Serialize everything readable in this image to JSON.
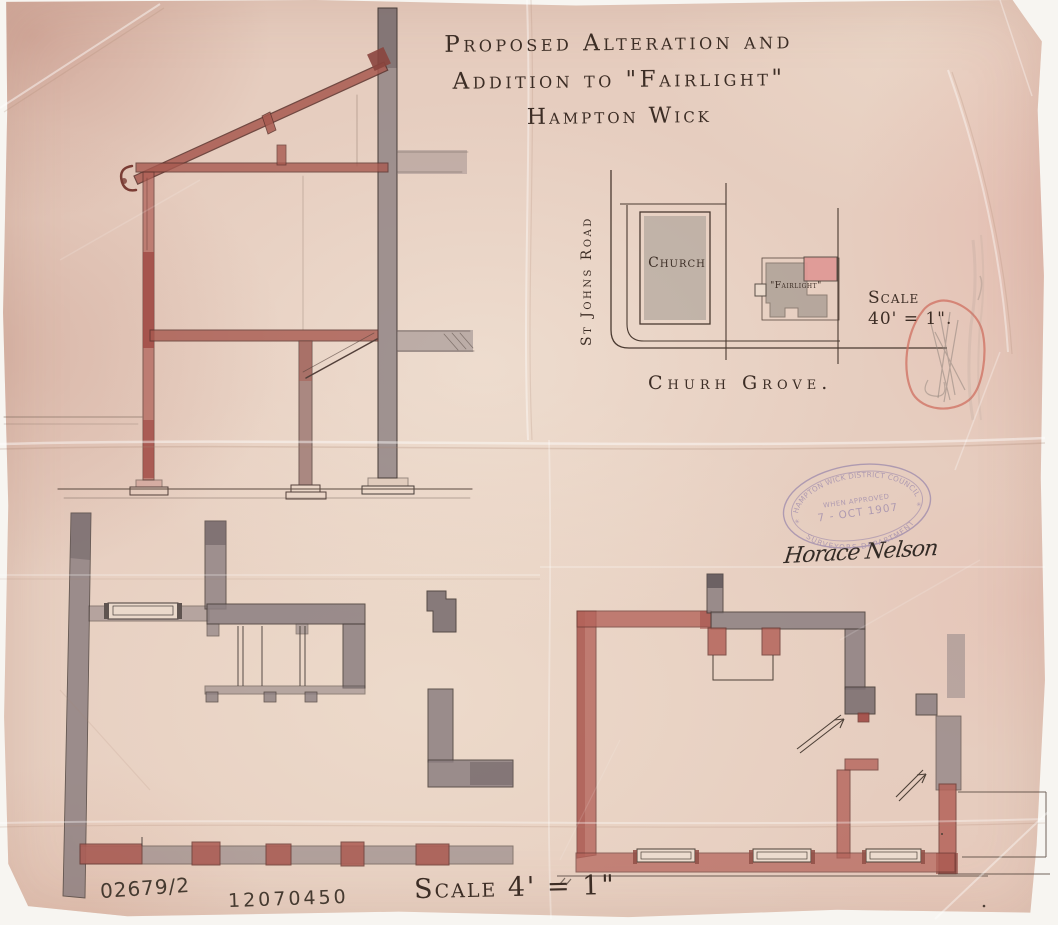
{
  "title": {
    "line1": "Proposed Alteration and",
    "line2": "Addition to \"Fairlight\"",
    "line3": "Hampton Wick"
  },
  "site_plan": {
    "church": "Church",
    "fairlight": "\"Fairlight\"",
    "road": "St Johns Road",
    "street": "Churh Grove.",
    "scale_word": "Scale",
    "scale_value": "40' = 1\"."
  },
  "floor_plans": {
    "scale_note": "Scale 4' = 1\""
  },
  "stamp": {
    "top": "HAMPTON WICK DISTRICT COUNCIL",
    "approved": "WHEN APPROVED",
    "date": "7 - OCT 1907",
    "bottom": "SURVEYORS DEPARTMENT"
  },
  "annotations": {
    "ref_left": "02679/2",
    "ref_right": "12070450",
    "signature": "Horace Nelson"
  },
  "colors": {
    "paper": "#e6cdbf",
    "ink": "#3c2d25",
    "red_wash": "#b4635a",
    "gray_wash": "#8c7f81",
    "pink_addition": "#e09a96",
    "stamp_purple": "#8d7ba8",
    "scribble_red": "#cf6f60"
  }
}
